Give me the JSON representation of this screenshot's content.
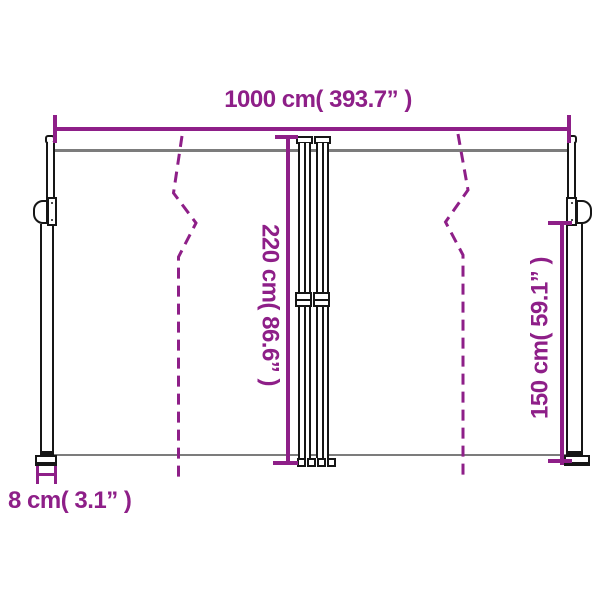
{
  "labels": {
    "total_width": "1000 cm( 393.7” )",
    "back_height": "220 cm( 86.6” )",
    "front_height": "150 cm( 59.1” )",
    "pole_depth": "8 cm( 3.1” )"
  },
  "colors": {
    "dimension": "#8E1F88",
    "fabric": "#7C7C7C",
    "frame": "#161616",
    "background": "#FFFFFF"
  }
}
